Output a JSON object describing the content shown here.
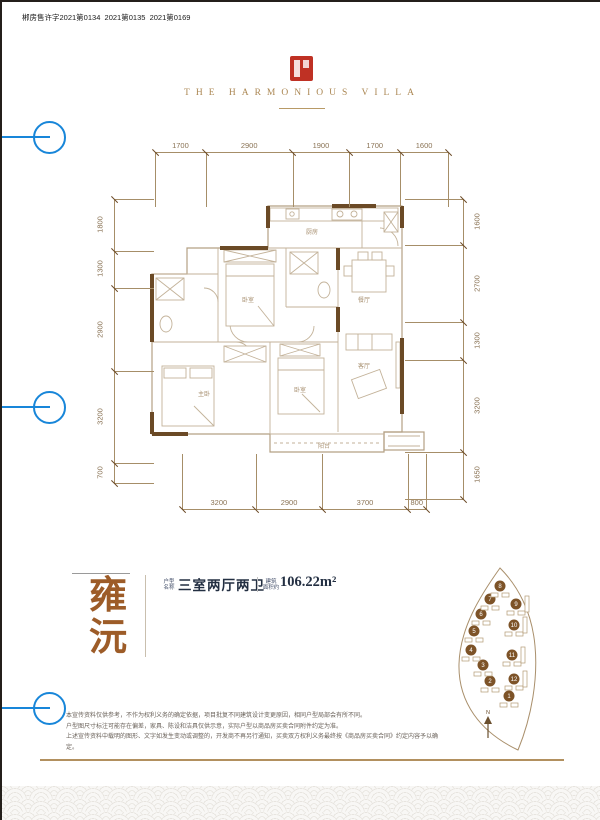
{
  "page": {
    "permit_text": "郴房售许字2021第0134  2021第0135  2021第0169"
  },
  "header": {
    "brand_name": "THE HARMONIOUS VILLA",
    "seal_icon": "red-seal"
  },
  "floor_plan": {
    "dimensions_mm": {
      "top": [
        1700,
        2900,
        1900,
        1700,
        1600
      ],
      "bottom": [
        3200,
        2900,
        3700,
        800
      ],
      "left": [
        1800,
        1300,
        2900,
        3200,
        700
      ],
      "right": [
        1600,
        2700,
        1300,
        3200,
        1650
      ]
    },
    "rooms": {
      "kitchen": "厨房",
      "dining": "餐厅",
      "living": "客厅",
      "balcony": "阳台",
      "master_bedroom": "主卧",
      "bedroom_a": "卧室",
      "bedroom_b": "卧室"
    }
  },
  "unit_info": {
    "name_char_1": "雍",
    "name_char_2": "沅",
    "layout_label_line1": "户型",
    "layout_label_line2": "名称",
    "layout_value": "三室两厅两卫",
    "area_label_line1": "建筑",
    "area_label_line2": "面积约",
    "area_value": "106.22m²"
  },
  "site_plan": {
    "building_numbers": [
      1,
      2,
      3,
      4,
      5,
      6,
      7,
      8,
      9,
      10,
      11,
      12
    ],
    "north_label": "N"
  },
  "disclaimer": {
    "line1": "本宣传资料仅供参考，不作为权利义务的确定依据，项目批复不同建筑设计变更原因，相同户型局部会有所不同。",
    "line2": "户型图尺寸标注可能存在偏差，家具、陈设和洁具仅供示意，实际户型以商品房买卖合同附件约定为准。",
    "line3": "上述宣传资料中载明的图形、文字如发生变动或调整的，开发商不再另行通知，买卖双方权利义务最终按《商品房买卖合同》约定内容予以确定。"
  },
  "colors": {
    "accent_blue": "#1886d9",
    "seal_red": "#bf3124",
    "wall_brown": "#6b4a26",
    "line_tan": "#b3a084",
    "gold": "#b2905f",
    "name_brown": "#9d5c28",
    "dim_brown": "#8a7355"
  }
}
